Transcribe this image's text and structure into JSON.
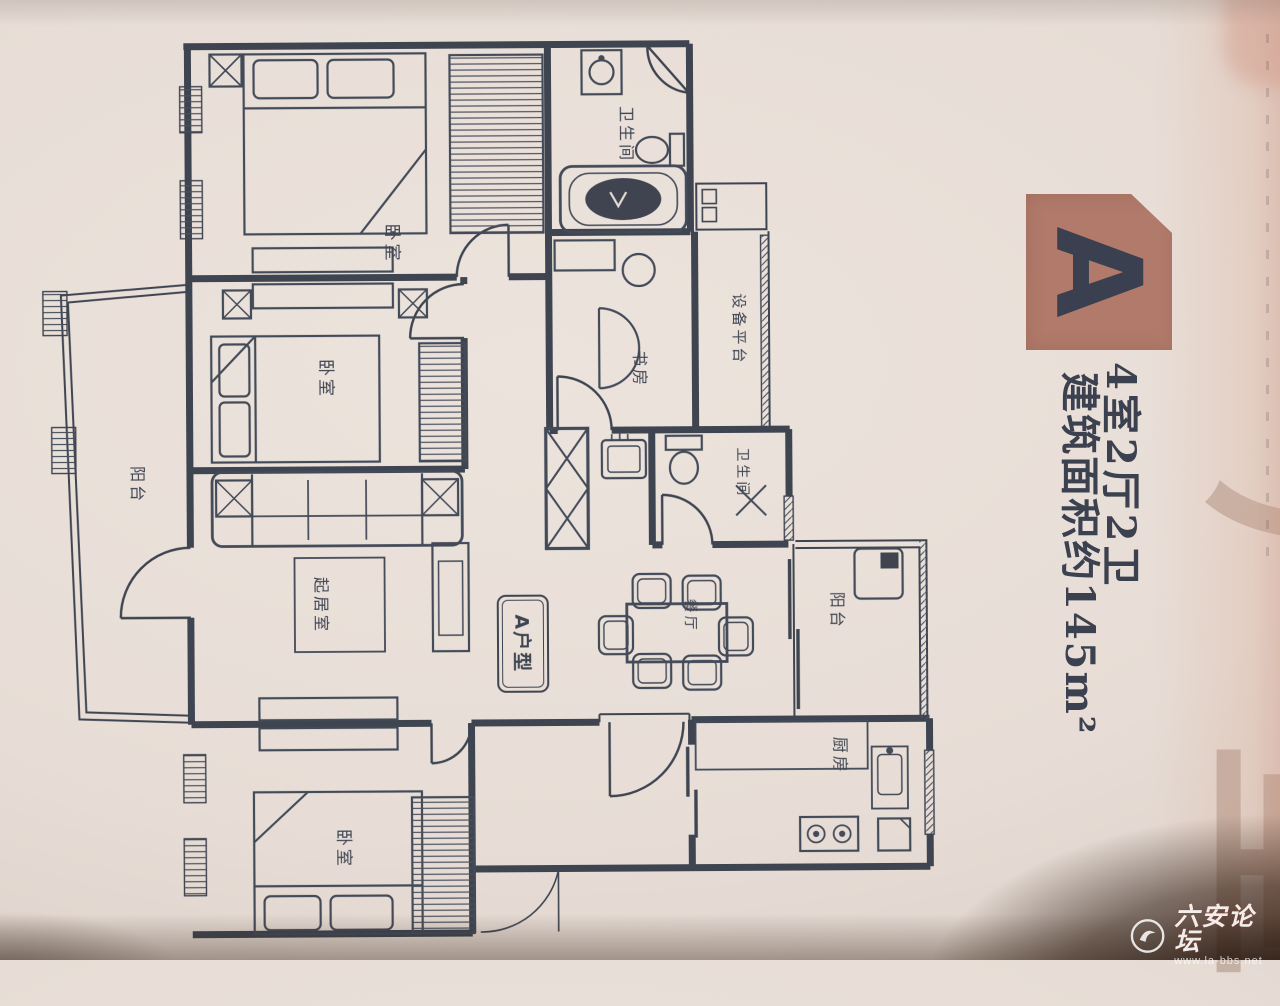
{
  "badge_letter": "A",
  "title_line1": "4室2厅2卫",
  "title_line2": "建筑面积约145m²",
  "side_text": "户型",
  "plan_badge": "A户型",
  "rooms": {
    "bedroom_top": "卧室",
    "bedroom_middle": "卧室",
    "bedroom_bottom": "卧室",
    "bathroom_top": "卫生间",
    "bathroom_middle": "卫生间",
    "study": "书房",
    "equipment_platform": "设备平台",
    "balcony_left": "阳台",
    "balcony_right": "阳台",
    "living_room": "起居室",
    "dining_room": "餐厅",
    "kitchen": "厨房"
  },
  "watermark": {
    "site_name": "六安论坛",
    "site_url": "www.la-bbs.net"
  },
  "colors": {
    "ink": "#3e4450",
    "badge": "#b17a6b",
    "paper": "#e7ddd6"
  }
}
